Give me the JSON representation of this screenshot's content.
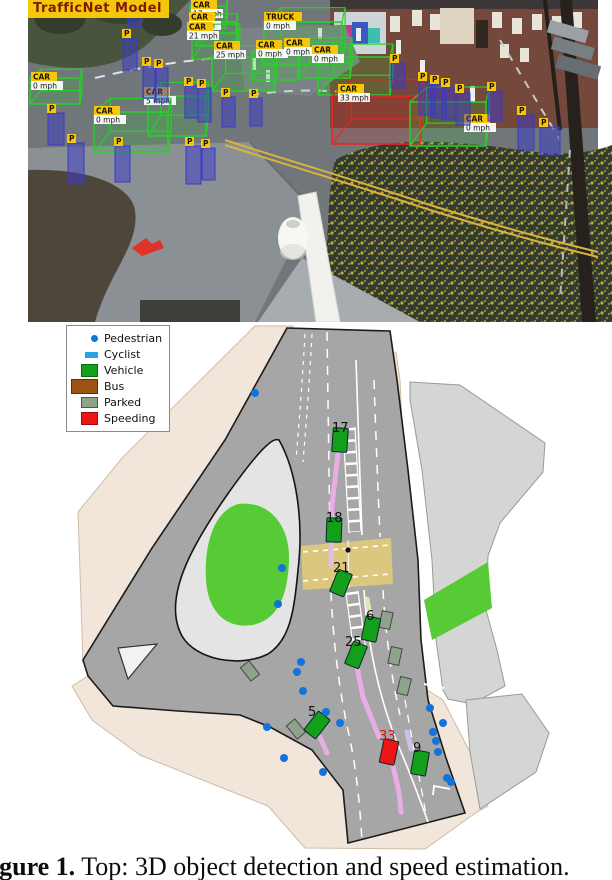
{
  "figure": {
    "caption_bold": "Figure 1.",
    "caption_rest": " Top: 3D object detection and speed estimation."
  },
  "photo": {
    "model_label": "TrafficNet Model",
    "colors": {
      "vehicle_box": "#27d127",
      "speeding_box": "#ef2020",
      "pedestrian_box": "#3939c8",
      "label_bg": "#f6c60a",
      "label_text": "#1d1400",
      "speed_bg": "#ffffff",
      "speed_text": "#111111"
    },
    "detections": [
      {
        "t": "CAR",
        "s": "17 mph",
        "x": 190,
        "y": 6,
        "w": 36,
        "h": 22,
        "lx": 191,
        "ly": 0,
        "red": false
      },
      {
        "t": "CAR",
        "s": "0 mph",
        "x": 196,
        "y": 22,
        "w": 40,
        "h": 24,
        "lx": 189,
        "ly": 12,
        "red": false
      },
      {
        "t": "CAR",
        "s": "21 mph",
        "x": 192,
        "y": 33,
        "w": 46,
        "h": 26,
        "lx": 187,
        "ly": 22,
        "red": false
      },
      {
        "t": "TRUCK",
        "s": "0 mph",
        "x": 264,
        "y": 22,
        "w": 78,
        "h": 42,
        "lx": 264,
        "ly": 12,
        "red": false
      },
      {
        "t": "CAR",
        "s": "25 mph",
        "x": 212,
        "y": 57,
        "w": 62,
        "h": 34,
        "lx": 214,
        "ly": 41,
        "red": false
      },
      {
        "t": "CAR",
        "s": "0 mph",
        "x": 252,
        "y": 52,
        "w": 46,
        "h": 28,
        "lx": 256,
        "ly": 40,
        "red": false
      },
      {
        "t": "CAR",
        "s": "0 mph",
        "x": 298,
        "y": 48,
        "w": 52,
        "h": 30,
        "lx": 284,
        "ly": 38,
        "red": false
      },
      {
        "t": "CAR",
        "s": "0 mph",
        "x": 318,
        "y": 57,
        "w": 72,
        "h": 38,
        "lx": 312,
        "ly": 45,
        "red": false
      },
      {
        "t": "CAR",
        "s": "0 mph",
        "x": 30,
        "y": 78,
        "w": 50,
        "h": 26,
        "lx": 31,
        "ly": 72,
        "red": false
      },
      {
        "t": "CAR",
        "s": "5 mph",
        "x": 148,
        "y": 96,
        "w": 58,
        "h": 40,
        "lx": 144,
        "ly": 87,
        "red": false
      },
      {
        "t": "CAR",
        "s": "0 mph",
        "x": 94,
        "y": 112,
        "w": 74,
        "h": 40,
        "lx": 94,
        "ly": 106,
        "red": false
      },
      {
        "t": "CAR",
        "s": "33 mph",
        "x": 332,
        "y": 96,
        "w": 88,
        "h": 48,
        "lx": 338,
        "ly": 84,
        "red": true
      },
      {
        "t": "CAR",
        "s": "0 mph",
        "x": 410,
        "y": 102,
        "w": 76,
        "h": 44,
        "lx": 464,
        "ly": 114,
        "red": false
      }
    ],
    "pedestrians": [
      {
        "x": 128,
        "y": 3,
        "w": 13,
        "h": 24
      },
      {
        "x": 123,
        "y": 38,
        "w": 14,
        "h": 32
      },
      {
        "x": 143,
        "y": 66,
        "w": 13,
        "h": 32
      },
      {
        "x": 155,
        "y": 68,
        "w": 13,
        "h": 34
      },
      {
        "x": 185,
        "y": 86,
        "w": 13,
        "h": 32
      },
      {
        "x": 198,
        "y": 88,
        "w": 13,
        "h": 34
      },
      {
        "x": 222,
        "y": 97,
        "w": 13,
        "h": 30
      },
      {
        "x": 250,
        "y": 98,
        "w": 12,
        "h": 28
      },
      {
        "x": 48,
        "y": 113,
        "w": 16,
        "h": 32
      },
      {
        "x": 68,
        "y": 143,
        "w": 16,
        "h": 40
      },
      {
        "x": 115,
        "y": 146,
        "w": 15,
        "h": 36
      },
      {
        "x": 186,
        "y": 146,
        "w": 15,
        "h": 38
      },
      {
        "x": 202,
        "y": 148,
        "w": 13,
        "h": 32
      },
      {
        "x": 391,
        "y": 63,
        "w": 14,
        "h": 25
      },
      {
        "x": 419,
        "y": 81,
        "w": 16,
        "h": 34
      },
      {
        "x": 431,
        "y": 84,
        "w": 15,
        "h": 34
      },
      {
        "x": 442,
        "y": 87,
        "w": 14,
        "h": 33
      },
      {
        "x": 456,
        "y": 93,
        "w": 14,
        "h": 32
      },
      {
        "x": 488,
        "y": 91,
        "w": 14,
        "h": 30
      },
      {
        "x": 518,
        "y": 115,
        "w": 16,
        "h": 35
      },
      {
        "x": 540,
        "y": 127,
        "w": 20,
        "h": 28
      }
    ]
  },
  "map": {
    "legend": {
      "items": [
        {
          "label": "Pedestrian",
          "color": "#1273dc",
          "shape": "dot"
        },
        {
          "label": "Cyclist",
          "color": "#29a3e6",
          "shape": "rect-small"
        },
        {
          "label": "Vehicle",
          "color": "#12a01a",
          "shape": "rect"
        },
        {
          "label": "Bus",
          "color": "#9a5414",
          "shape": "rect-wide"
        },
        {
          "label": "Parked",
          "color": "#8fa28c",
          "shape": "rect-flat"
        },
        {
          "label": "Speeding",
          "color": "#ee1515",
          "shape": "rect"
        }
      ]
    },
    "colors": {
      "vehicle": "#12a01a",
      "speeding": "#ee1515",
      "parked": "#8fa28c",
      "pedestrian": "#1273dc",
      "label_text": "#111111",
      "speeding_label_text": "#d40f0f"
    },
    "vehicles": [
      {
        "id": "17",
        "x": 340,
        "y": 440,
        "rot": 4,
        "lx": 332,
        "ly": 432,
        "speeding": false
      },
      {
        "id": "18",
        "x": 334,
        "y": 530,
        "rot": 2,
        "lx": 326,
        "ly": 522,
        "speeding": false
      },
      {
        "id": "21",
        "x": 341,
        "y": 583,
        "rot": 22,
        "lx": 333,
        "ly": 572,
        "speeding": false
      },
      {
        "id": "25",
        "x": 356,
        "y": 655,
        "rot": 22,
        "lx": 345,
        "ly": 646,
        "speeding": false
      },
      {
        "id": "6",
        "x": 371,
        "y": 629,
        "rot": 12,
        "lx": 366,
        "ly": 620,
        "speeding": false
      },
      {
        "id": "5",
        "x": 317,
        "y": 725,
        "rot": 38,
        "lx": 308,
        "ly": 716,
        "speeding": false
      },
      {
        "id": "9",
        "x": 420,
        "y": 763,
        "rot": 10,
        "lx": 413,
        "ly": 752,
        "speeding": false
      },
      {
        "id": "33",
        "x": 389,
        "y": 752,
        "rot": 12,
        "lx": 379,
        "ly": 740,
        "speeding": true
      }
    ],
    "parked": [
      {
        "x": 386,
        "y": 620,
        "rot": 12
      },
      {
        "x": 395,
        "y": 656,
        "rot": 12
      },
      {
        "x": 404,
        "y": 686,
        "rot": 14
      },
      {
        "x": 250,
        "y": 671,
        "rot": -38
      },
      {
        "x": 296,
        "y": 729,
        "rot": -40
      }
    ],
    "pedestrian_dots": [
      [
        255,
        393
      ],
      [
        282,
        568
      ],
      [
        278,
        604
      ],
      [
        301,
        662
      ],
      [
        297,
        672
      ],
      [
        303,
        691
      ],
      [
        326,
        712
      ],
      [
        340,
        723
      ],
      [
        267,
        727
      ],
      [
        284,
        758
      ],
      [
        323,
        772
      ],
      [
        430,
        708
      ],
      [
        443,
        723
      ],
      [
        433,
        732
      ],
      [
        436,
        741
      ],
      [
        438,
        752
      ],
      [
        447,
        778
      ],
      [
        451,
        782
      ]
    ],
    "crossing_beacons": [
      [
        348,
        550
      ],
      [
        349,
        578
      ]
    ],
    "trails": [
      {
        "color": "#f3aef0",
        "points": [
          [
            338,
            453
          ],
          [
            332,
            505
          ],
          [
            331,
            540
          ]
        ]
      },
      {
        "color": "#dcc0f0",
        "points": [
          [
            331,
            544
          ],
          [
            331,
            566
          ]
        ]
      },
      {
        "color": "#f3aef0",
        "points": [
          [
            354,
            652
          ],
          [
            363,
            697
          ],
          [
            379,
            737
          ]
        ]
      },
      {
        "color": "#f3aef0",
        "points": [
          [
            393,
            766
          ],
          [
            399,
            792
          ],
          [
            401,
            812
          ]
        ]
      },
      {
        "color": "#f3aef0",
        "points": [
          [
            320,
            737
          ],
          [
            327,
            753
          ]
        ]
      },
      {
        "color": "#d8c2ee",
        "points": [
          [
            407,
            732
          ],
          [
            411,
            749
          ]
        ]
      },
      {
        "color": "#f0ecc0",
        "points": [
          [
            367,
            599
          ],
          [
            371,
            621
          ]
        ]
      }
    ]
  }
}
